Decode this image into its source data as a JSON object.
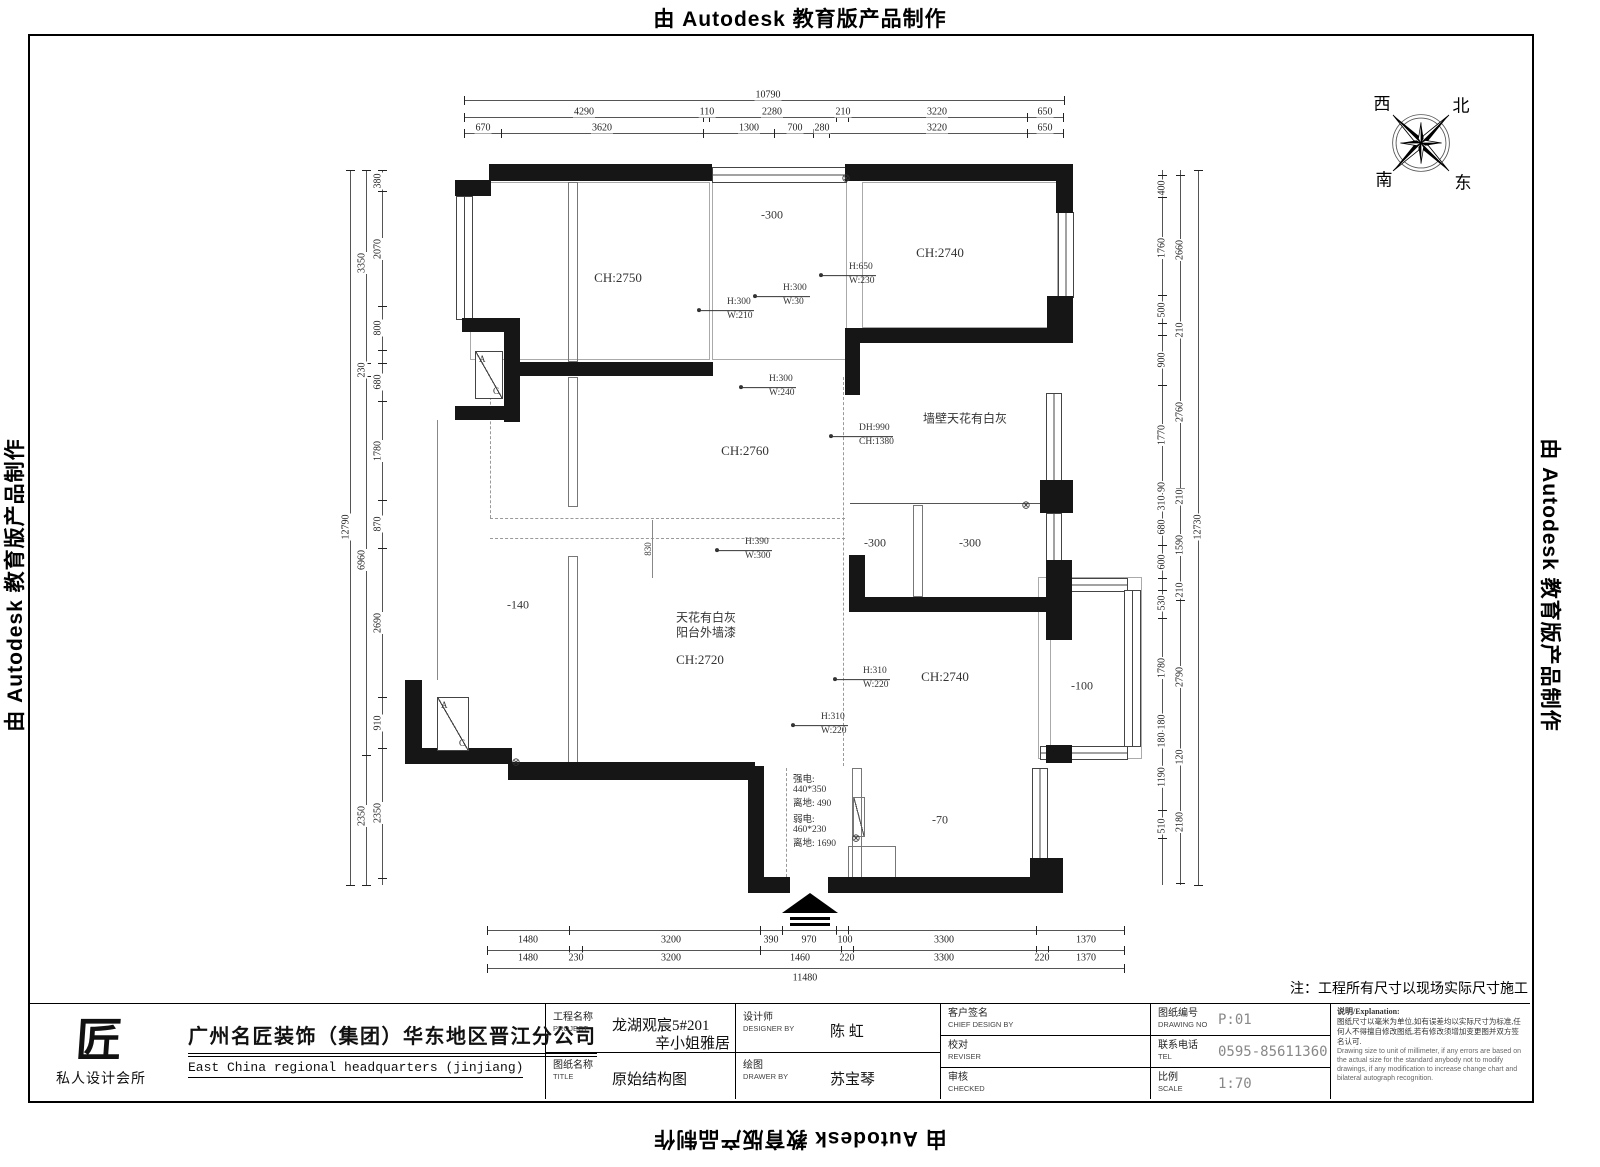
{
  "banners": {
    "text": "由 Autodesk 教育版产品制作"
  },
  "compass": {
    "west": "西",
    "north": "北",
    "south": "南",
    "east": "东"
  },
  "note": "注：工程所有尺寸以现场实际尺寸施工",
  "plan": {
    "drain_symbol": "⊗",
    "ac_a": "A",
    "ac_c": "C",
    "annotations": [
      {
        "t": "CH:2750",
        "x": 618,
        "y": 278,
        "s": "room"
      },
      {
        "t": "-300",
        "x": 772,
        "y": 215,
        "s": "rooms"
      },
      {
        "t": "CH:2740",
        "x": 940,
        "y": 253,
        "s": "room"
      },
      {
        "t": "H:650",
        "t2": "W:230",
        "x": 848,
        "y": 275,
        "s": "hw"
      },
      {
        "t": "H:300",
        "t2": "W:210",
        "x": 726,
        "y": 310,
        "s": "hw"
      },
      {
        "t": "H:300",
        "t2": "W:30",
        "x": 782,
        "y": 296,
        "s": "hw"
      },
      {
        "t": "H:300",
        "t2": "W:240",
        "x": 768,
        "y": 387,
        "s": "hw"
      },
      {
        "t": "墙壁天花有白灰",
        "x": 965,
        "y": 418,
        "s": "rooms"
      },
      {
        "t": "DH:990",
        "t2": "CH:1380",
        "x": 858,
        "y": 436,
        "s": "hw"
      },
      {
        "t": "CH:2760",
        "x": 745,
        "y": 451,
        "s": "room"
      },
      {
        "t": "H:390",
        "t2": "W:300",
        "x": 744,
        "y": 550,
        "s": "hw"
      },
      {
        "t": "-300",
        "x": 875,
        "y": 543,
        "s": "rooms"
      },
      {
        "t": "-300",
        "x": 970,
        "y": 543,
        "s": "rooms"
      },
      {
        "t": "-140",
        "x": 518,
        "y": 605,
        "s": "rooms"
      },
      {
        "t": "天花有白灰",
        "x": 706,
        "y": 617,
        "s": "rooms"
      },
      {
        "t": "阳台外墙漆",
        "x": 706,
        "y": 632,
        "s": "rooms"
      },
      {
        "t": "CH:2720",
        "x": 700,
        "y": 660,
        "s": "room"
      },
      {
        "t": "H:310",
        "t2": "W:220",
        "x": 862,
        "y": 679,
        "s": "hw"
      },
      {
        "t": "CH:2740",
        "x": 945,
        "y": 677,
        "s": "room"
      },
      {
        "t": "-100",
        "x": 1082,
        "y": 686,
        "s": "rooms"
      },
      {
        "t": "H:310",
        "t2": "W:220",
        "x": 820,
        "y": 725,
        "s": "hw"
      },
      {
        "t": "强电:",
        "x": 793,
        "y": 778,
        "s": "tiny"
      },
      {
        "t": "440*350",
        "x": 793,
        "y": 790,
        "s": "tiny"
      },
      {
        "t": "离地: 490",
        "x": 793,
        "y": 802,
        "s": "tiny"
      },
      {
        "t": "弱电:",
        "x": 793,
        "y": 818,
        "s": "tiny"
      },
      {
        "t": "460*230",
        "x": 793,
        "y": 830,
        "s": "tiny"
      },
      {
        "t": "离地: 1690",
        "x": 793,
        "y": 842,
        "s": "tiny"
      },
      {
        "t": "-70",
        "x": 940,
        "y": 820,
        "s": "rooms"
      },
      {
        "t": "830",
        "x": 648,
        "y": 549,
        "s": "vdim"
      }
    ]
  },
  "dims": {
    "top": {
      "total": {
        "t": "10790",
        "x": 768,
        "y": 95
      },
      "row2": {
        "y": 112,
        "items": [
          {
            "t": "4290",
            "x": 584
          },
          {
            "t": "110",
            "x": 707
          },
          {
            "t": "2280",
            "x": 772
          },
          {
            "t": "210",
            "x": 843
          },
          {
            "t": "3220",
            "x": 937
          },
          {
            "t": "650",
            "x": 1045
          }
        ]
      },
      "row3": {
        "y": 128,
        "items": [
          {
            "t": "670",
            "x": 483
          },
          {
            "t": "3620",
            "x": 602
          },
          {
            "t": "1300",
            "x": 749
          },
          {
            "t": "700",
            "x": 795
          },
          {
            "t": "280",
            "x": 822
          },
          {
            "t": "3220",
            "x": 937
          },
          {
            "t": "650",
            "x": 1045
          }
        ]
      }
    },
    "bottom": {
      "row1": {
        "y": 940,
        "items": [
          {
            "t": "1480",
            "x": 528
          },
          {
            "t": "3200",
            "x": 671
          },
          {
            "t": "390",
            "x": 771
          },
          {
            "t": "970",
            "x": 809
          },
          {
            "t": "100",
            "x": 845
          },
          {
            "t": "3300",
            "x": 944
          },
          {
            "t": "1370",
            "x": 1086
          }
        ]
      },
      "row2": {
        "y": 958,
        "items": [
          {
            "t": "1480",
            "x": 528
          },
          {
            "t": "230",
            "x": 576
          },
          {
            "t": "3200",
            "x": 671
          },
          {
            "t": "1460",
            "x": 800
          },
          {
            "t": "220",
            "x": 847
          },
          {
            "t": "3300",
            "x": 944
          },
          {
            "t": "220",
            "x": 1042
          },
          {
            "t": "1370",
            "x": 1086
          }
        ]
      },
      "total": {
        "t": "11480",
        "x": 805,
        "y": 978
      }
    },
    "left": {
      "col1": {
        "x": 378,
        "items": [
          {
            "t": "380",
            "y": 181
          },
          {
            "t": "2070",
            "y": 249
          },
          {
            "t": "800",
            "y": 328
          },
          {
            "t": "680",
            "y": 382
          },
          {
            "t": "1780",
            "y": 451
          },
          {
            "t": "870",
            "y": 524
          },
          {
            "t": "2690",
            "y": 623
          },
          {
            "t": "910",
            "y": 723
          },
          {
            "t": "2350",
            "y": 813
          }
        ]
      },
      "col2": {
        "x": 362,
        "items": [
          {
            "t": "3350",
            "y": 263
          },
          {
            "t": "230",
            "y": 370
          },
          {
            "t": "6960",
            "y": 560
          },
          {
            "t": "2350",
            "y": 816
          }
        ]
      },
      "total": {
        "t": "12790",
        "x": 346,
        "y": 527
      }
    },
    "right": {
      "col1": {
        "x": 1162,
        "items": [
          {
            "t": "400",
            "y": 188
          },
          {
            "t": "1760",
            "y": 248
          },
          {
            "t": "500",
            "y": 310
          },
          {
            "t": "900",
            "y": 360
          },
          {
            "t": "1770",
            "y": 435
          },
          {
            "t": "90",
            "y": 487
          },
          {
            "t": "310",
            "y": 503
          },
          {
            "t": "680",
            "y": 527
          },
          {
            "t": "600",
            "y": 562
          },
          {
            "t": "530",
            "y": 603
          },
          {
            "t": "1780",
            "y": 668
          },
          {
            "t": "180",
            "y": 722
          },
          {
            "t": "180",
            "y": 740
          },
          {
            "t": "1190",
            "y": 777
          },
          {
            "t": "510",
            "y": 826
          }
        ]
      },
      "col2": {
        "x": 1180,
        "items": [
          {
            "t": "2660",
            "y": 250
          },
          {
            "t": "210",
            "y": 330
          },
          {
            "t": "2760",
            "y": 412
          },
          {
            "t": "210",
            "y": 497
          },
          {
            "t": "1590",
            "y": 545
          },
          {
            "t": "210",
            "y": 590
          },
          {
            "t": "2790",
            "y": 677
          },
          {
            "t": "120",
            "y": 757
          },
          {
            "t": "2180",
            "y": 822
          }
        ]
      },
      "total": {
        "t": "12730",
        "x": 1198,
        "y": 527
      }
    }
  },
  "titleblock": {
    "logo_text": "匠",
    "studio": "私人设计会所",
    "company_cn": "广州名匠装饰（集团）华东地区晋江分公司",
    "company_en": "East China regional headquarters (jinjiang)",
    "fields": {
      "project_label": "工程名称",
      "project_label_en": "PROJECT",
      "project_value1": "龙湖观宸5#201",
      "project_value2": "辛小姐雅居",
      "designer_label": "设计师",
      "designer_label_en": "DESIGNER BY",
      "designer_value": "陈 虹",
      "title_label": "图纸名称",
      "title_label_en": "TITLE",
      "title_value": "原始结构图",
      "drawer_label": "绘图",
      "drawer_label_en": "DRAWER BY",
      "drawer_value": "苏宝琴",
      "client_label": "客户签名",
      "client_label_en": "CHIEF DESIGN BY",
      "client_value": "",
      "reviser_label": "校对",
      "reviser_label_en": "REVISER",
      "reviser_value": "",
      "checker_label": "审核",
      "checker_label_en": "CHECKED",
      "checker_value": "",
      "drawingno_label": "图纸编号",
      "drawingno_label_en": "DRAWING NO",
      "drawingno_value": "P:01",
      "tel_label": "联系电话",
      "tel_label_en": "TEL",
      "tel_value": "0595-85611360",
      "scale_label": "比例",
      "scale_label_en": "SCALE",
      "scale_value": "1:70"
    },
    "explanation": {
      "title": "说明/Explanation:",
      "cn": "图纸尺寸以毫米为单位,如有误差均以实际尺寸为标准,任何人不得擅自修改图纸,若有修改须增加变更图并双方签名认可.",
      "en": "Drawing size to unit of millimeter, if any errors are based on the actual size for the standard anybody not to modify drawings, if any modification to increase change chart and bilateral autograph recognition."
    }
  }
}
